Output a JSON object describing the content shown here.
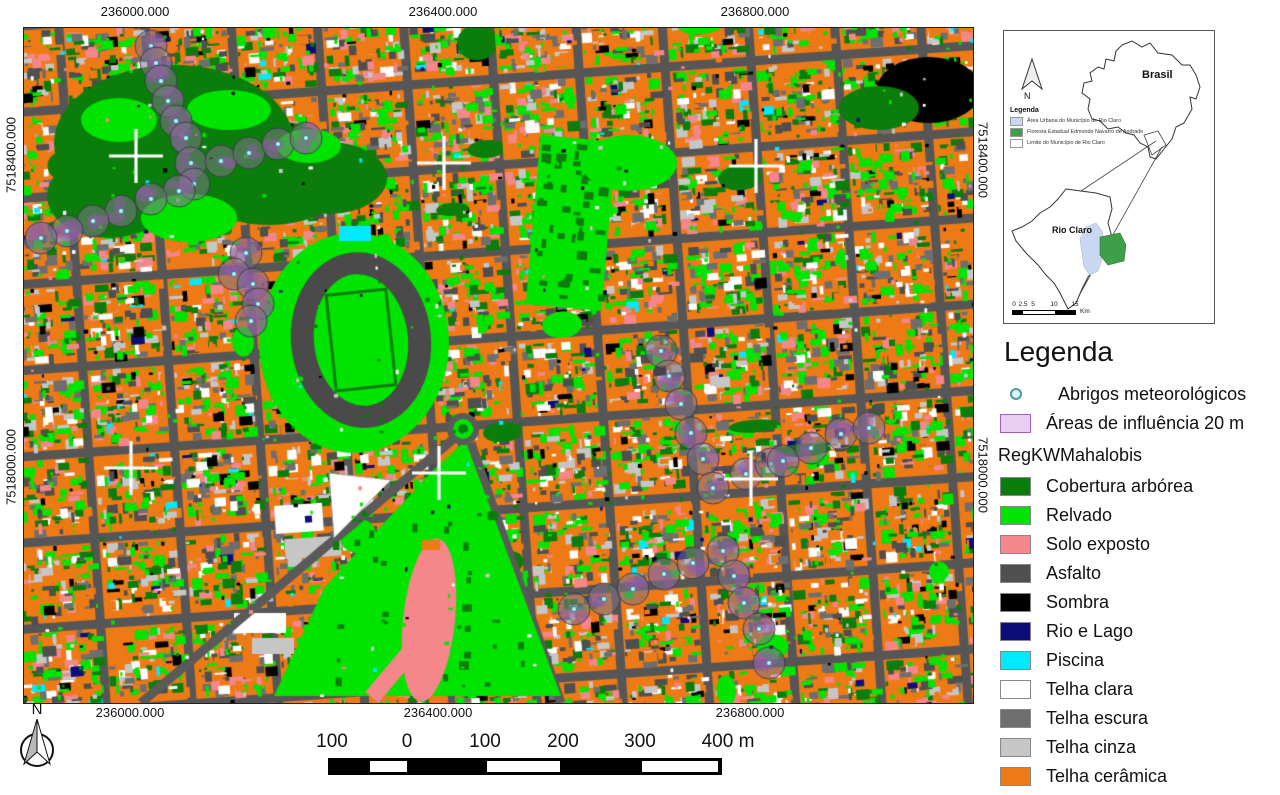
{
  "map": {
    "grid": {
      "top_labels": [
        "236000.000",
        "236400.000",
        "236800.000"
      ],
      "bottom_labels": [
        "236000.000",
        "236400.000",
        "236800.000"
      ],
      "left_labels": [
        "7518400.000",
        "7518000.000"
      ],
      "right_labels": [
        "7518400.000",
        "7518000.000"
      ]
    },
    "class_colors": {
      "cobertura_arborea": "#0a7d0a",
      "relvado": "#00e400",
      "solo_exposto": "#f5868a",
      "asfalto": "#4f4f4f",
      "sombra": "#000000",
      "rio_e_lago": "#0d0d7a",
      "piscina": "#00e9ff",
      "telha_clara": "#ffffff",
      "telha_escura": "#6e6e6e",
      "telha_cinza": "#c6c6c6",
      "telha_ceramica": "#ee7a16"
    },
    "influence_radius_px": 16,
    "crosses": [
      [
        112,
        128
      ],
      [
        420,
        135
      ],
      [
        732,
        138
      ],
      [
        107,
        440
      ],
      [
        415,
        445
      ],
      [
        727,
        451
      ]
    ],
    "shelters": [
      [
        127,
        18
      ],
      [
        132,
        35
      ],
      [
        137,
        53
      ],
      [
        144,
        73
      ],
      [
        152,
        93
      ],
      [
        162,
        110
      ],
      [
        167,
        135
      ],
      [
        170,
        156
      ],
      [
        155,
        163
      ],
      [
        127,
        171
      ],
      [
        97,
        183
      ],
      [
        69,
        193
      ],
      [
        43,
        203
      ],
      [
        17,
        210
      ],
      [
        197,
        133
      ],
      [
        225,
        125
      ],
      [
        254,
        116
      ],
      [
        282,
        110
      ],
      [
        222,
        225
      ],
      [
        210,
        246
      ],
      [
        229,
        256
      ],
      [
        234,
        276
      ],
      [
        227,
        293
      ],
      [
        637,
        323
      ],
      [
        645,
        348
      ],
      [
        657,
        376
      ],
      [
        667,
        405
      ],
      [
        679,
        431
      ],
      [
        689,
        460
      ],
      [
        722,
        446
      ],
      [
        747,
        436
      ],
      [
        759,
        433
      ],
      [
        787,
        420
      ],
      [
        817,
        406
      ],
      [
        845,
        400
      ],
      [
        550,
        581
      ],
      [
        580,
        571
      ],
      [
        609,
        561
      ],
      [
        640,
        546
      ],
      [
        669,
        535
      ],
      [
        699,
        523
      ],
      [
        710,
        548
      ],
      [
        720,
        575
      ],
      [
        735,
        601
      ],
      [
        745,
        635
      ]
    ]
  },
  "north_arrow": {
    "label": "N"
  },
  "scalebar": {
    "labels": [
      "100",
      "0",
      "100",
      "200",
      "300",
      "400 m"
    ]
  },
  "inset": {
    "north_label": "N",
    "country_label": "Brasil",
    "municipality_label": "Rio Claro",
    "legend_title": "Legenda",
    "legend_items": [
      {
        "label": "Área Urbana do Município de Rio Claro",
        "color": "#c9d8f0"
      },
      {
        "label": "Floresta Estadual Edmundo Navarro de Andrade",
        "color": "#3da048"
      },
      {
        "label": "Limite do Município de Rio Claro",
        "color": "#ffffff"
      }
    ],
    "scalebar_numbers": [
      "0",
      "2.5",
      "5",
      "10",
      "15"
    ],
    "scalebar_unit": "Km"
  },
  "legend": {
    "title": "Legenda",
    "point_item": {
      "label": "Abrigos meteorológicos"
    },
    "area_item": {
      "label": "Áreas de influência 20 m",
      "color": "#e9cdf3"
    },
    "group_title": "RegKWMahalobis",
    "classes": [
      {
        "label": "Cobertura arbórea",
        "color": "#0a7d0a"
      },
      {
        "label": "Relvado",
        "color": "#00e400"
      },
      {
        "label": "Solo exposto",
        "color": "#f5868a"
      },
      {
        "label": "Asfalto",
        "color": "#4f4f4f"
      },
      {
        "label": "Sombra",
        "color": "#000000"
      },
      {
        "label": "Rio e Lago",
        "color": "#0d0d7a"
      },
      {
        "label": "Piscina",
        "color": "#00e9ff"
      },
      {
        "label": "Telha clara",
        "color": "#ffffff"
      },
      {
        "label": "Telha escura",
        "color": "#6e6e6e"
      },
      {
        "label": "Telha cinza",
        "color": "#c6c6c6"
      },
      {
        "label": "Telha cerâmica",
        "color": "#ee7a16"
      }
    ]
  }
}
